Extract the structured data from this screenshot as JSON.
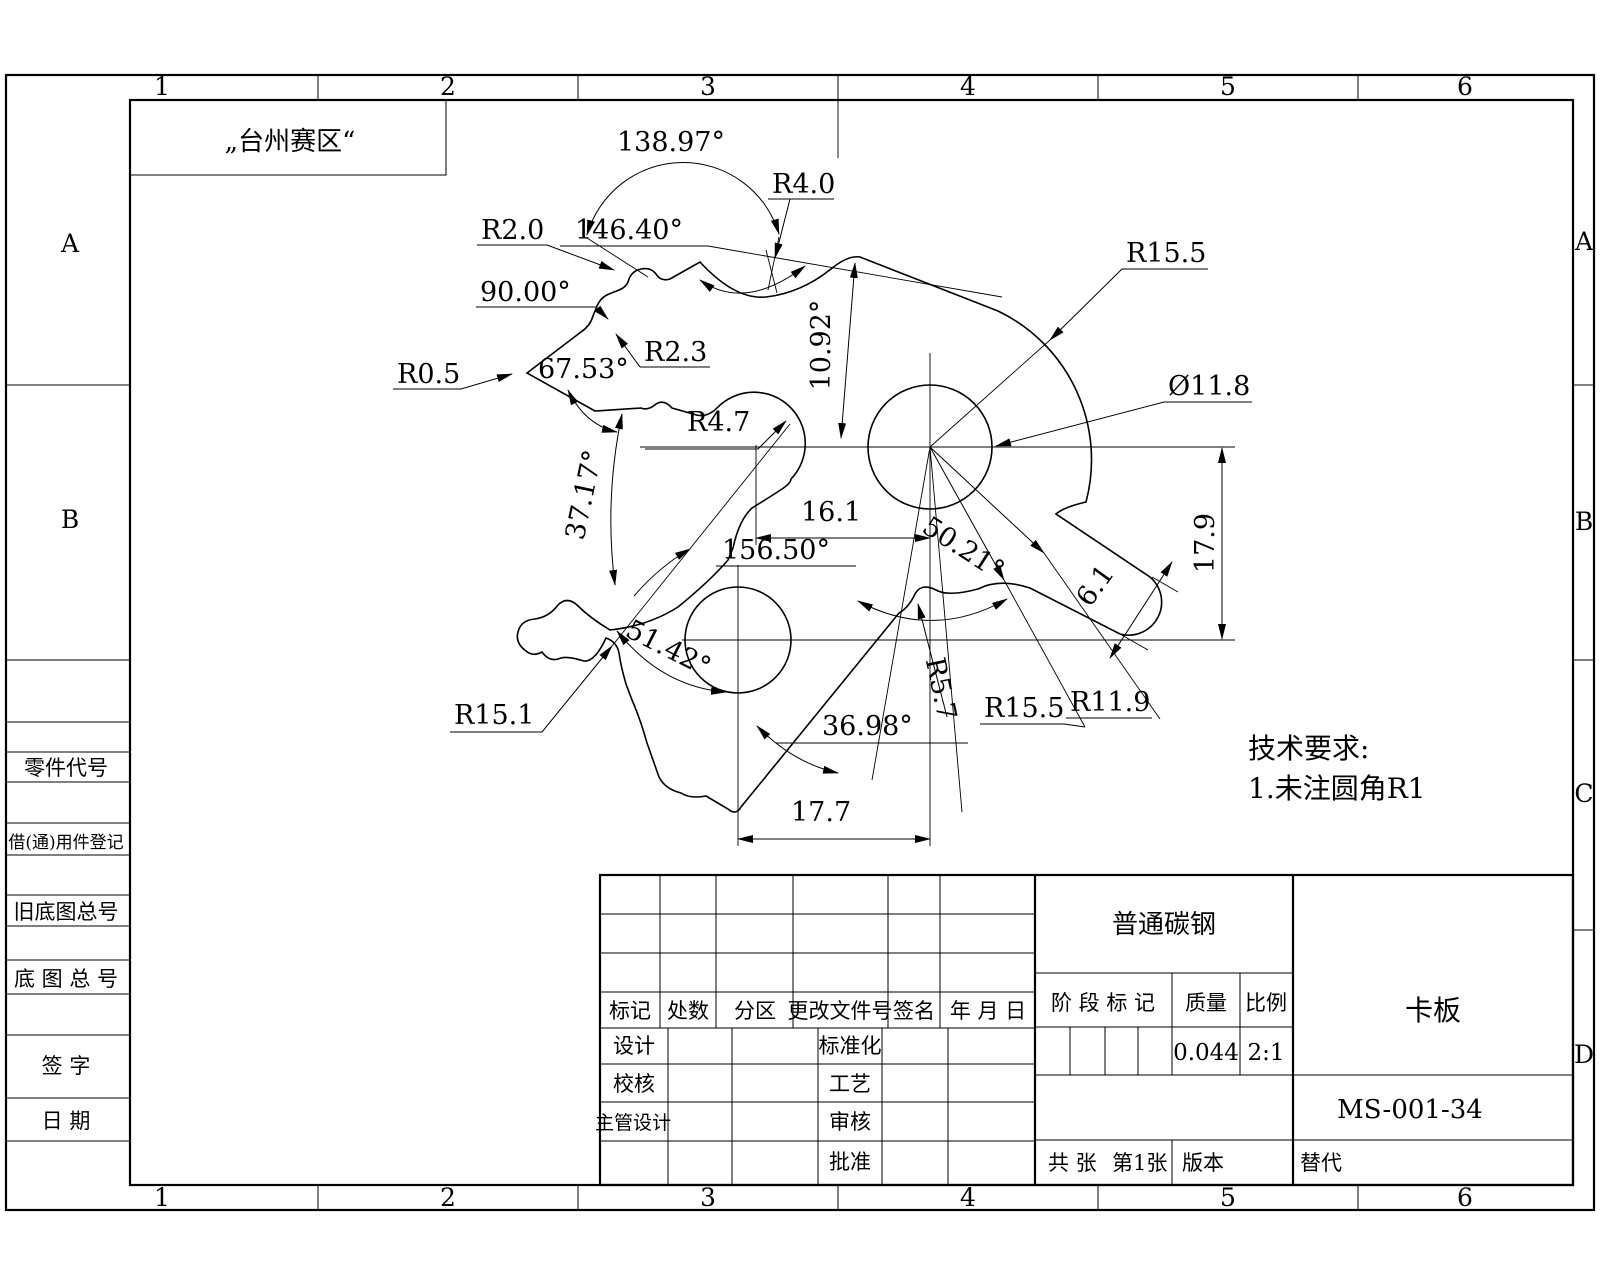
{
  "style": {
    "ink": "#000000",
    "paper": "#ffffff"
  },
  "frame": {
    "zones_top": [
      "1",
      "2",
      "3",
      "4",
      "5",
      "6"
    ],
    "zones_bottom": [
      "1",
      "2",
      "3",
      "4",
      "5",
      "6"
    ],
    "zones_left": [
      "A",
      "B"
    ],
    "zones_right": [
      "A",
      "B",
      "C",
      "D"
    ],
    "note": "„台州赛区“"
  },
  "margin_fields": {
    "part_no": "零件代号",
    "borrow_reg": "借(通)用件登记",
    "old_master_no": "旧底图总号",
    "master_no": "底 图 总 号",
    "signature": "签    字",
    "date": "日    期"
  },
  "dims": {
    "a138_97": "138.97°",
    "r4_0": "R4.0",
    "r2_0": "R2.0",
    "a146_40": "146.40°",
    "a90_00": "90.00°",
    "r2_3": "R2.3",
    "r0_5": "R0.5",
    "a67_53": "67.53°",
    "a10_92": "10.92°",
    "r15_5_top": "R15.5",
    "d11_8": "Ø11.8",
    "r4_7": "R4.7",
    "a37_17": "37.17°",
    "n16_1": "16.1",
    "a156_50": "156.50°",
    "a50_21": "50.21°",
    "n6_1": "6.1",
    "n17_9": "17.9",
    "a51_42": "51.42°",
    "r15_1": "R15.1",
    "r5_7": "R5.7",
    "r15_5_bot": "R15.5",
    "r11_9": "R11.9",
    "a36_98": "36.98°",
    "n17_7": "17.7"
  },
  "tech": {
    "title": "技术要求:",
    "item1": "1.未注圆角R1"
  },
  "tb": {
    "material": "普通碳钢",
    "part_name": "卡板",
    "drawing_no": "MS-001-34",
    "stage_label": "阶 段 标 记",
    "mass_label": "质量",
    "scale_label": "比例",
    "mass": "0.044",
    "scale": "2:1",
    "h_mark": "标记",
    "h_count": "处数",
    "h_zone": "分区",
    "h_doc": "更改文件号",
    "h_sign": "签名",
    "h_date": "年 月 日",
    "design": "设计",
    "standardize": "标准化",
    "check": "校核",
    "process": "工艺",
    "chief": "主管设计",
    "audit": "审核",
    "approve": "批准",
    "total": "共  张",
    "page": "第1张",
    "version": "版本",
    "replace": "替代"
  }
}
